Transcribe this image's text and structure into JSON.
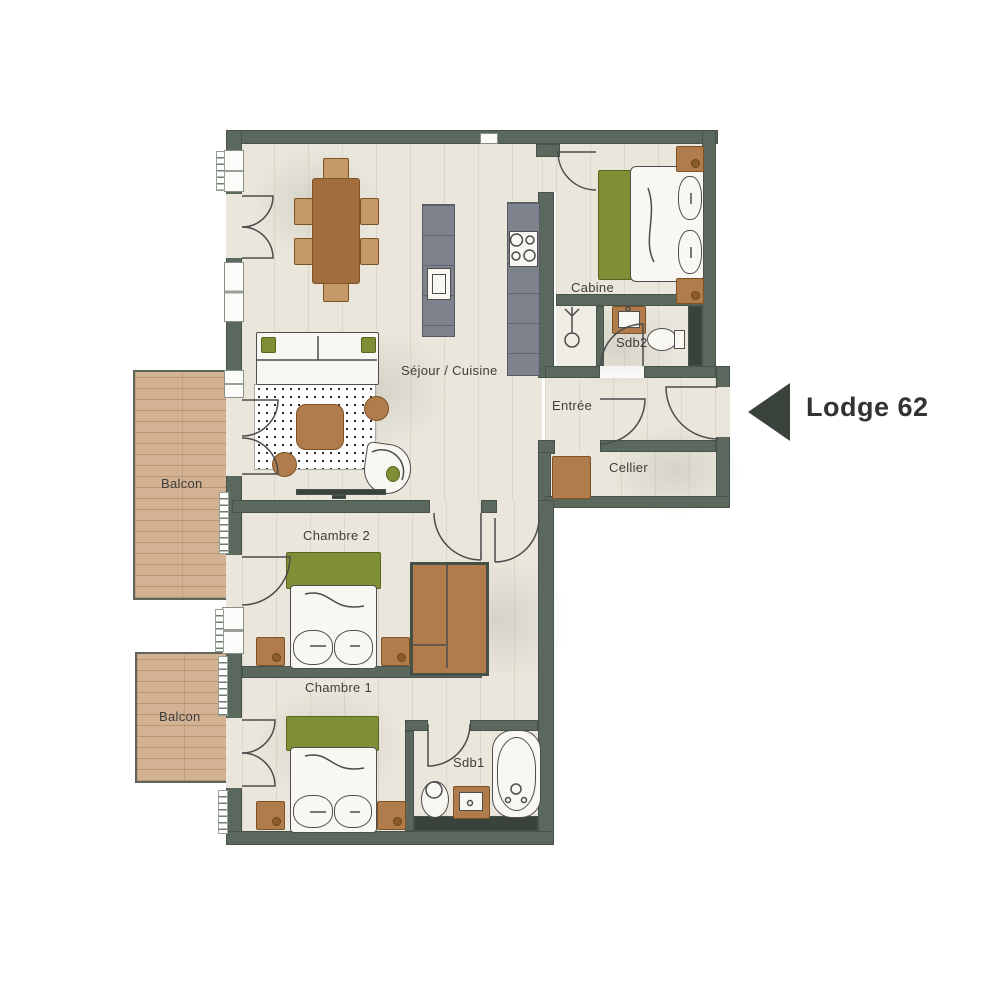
{
  "title": "Lodge 62",
  "plan": {
    "rooms": [
      {
        "id": "sejour",
        "label": "Séjour / Cuisine"
      },
      {
        "id": "cabine",
        "label": "Cabine"
      },
      {
        "id": "sdb2",
        "label": "Sdb2"
      },
      {
        "id": "entree",
        "label": "Entrée"
      },
      {
        "id": "cellier",
        "label": "Cellier"
      },
      {
        "id": "chambre2",
        "label": "Chambre 2"
      },
      {
        "id": "chambre1",
        "label": "Chambre 1"
      },
      {
        "id": "sdb1",
        "label": "Sdb1"
      },
      {
        "id": "balcon1",
        "label": "Balcon"
      },
      {
        "id": "balcon2",
        "label": "Balcon"
      }
    ],
    "marker": {
      "label": "Lodge 62",
      "icon": "left-arrow-icon"
    }
  },
  "colors": {
    "wall": "#5b685e",
    "wall_dark": "#39433b",
    "floor": "#eae6db",
    "balcony_wood": "#d2b292",
    "furniture_brown": "#b17c4b",
    "accent_green": "#7e8f35",
    "kitchen_gray": "#7d828d",
    "label_text": "#3d3d3d",
    "marker_text": "#333333"
  }
}
